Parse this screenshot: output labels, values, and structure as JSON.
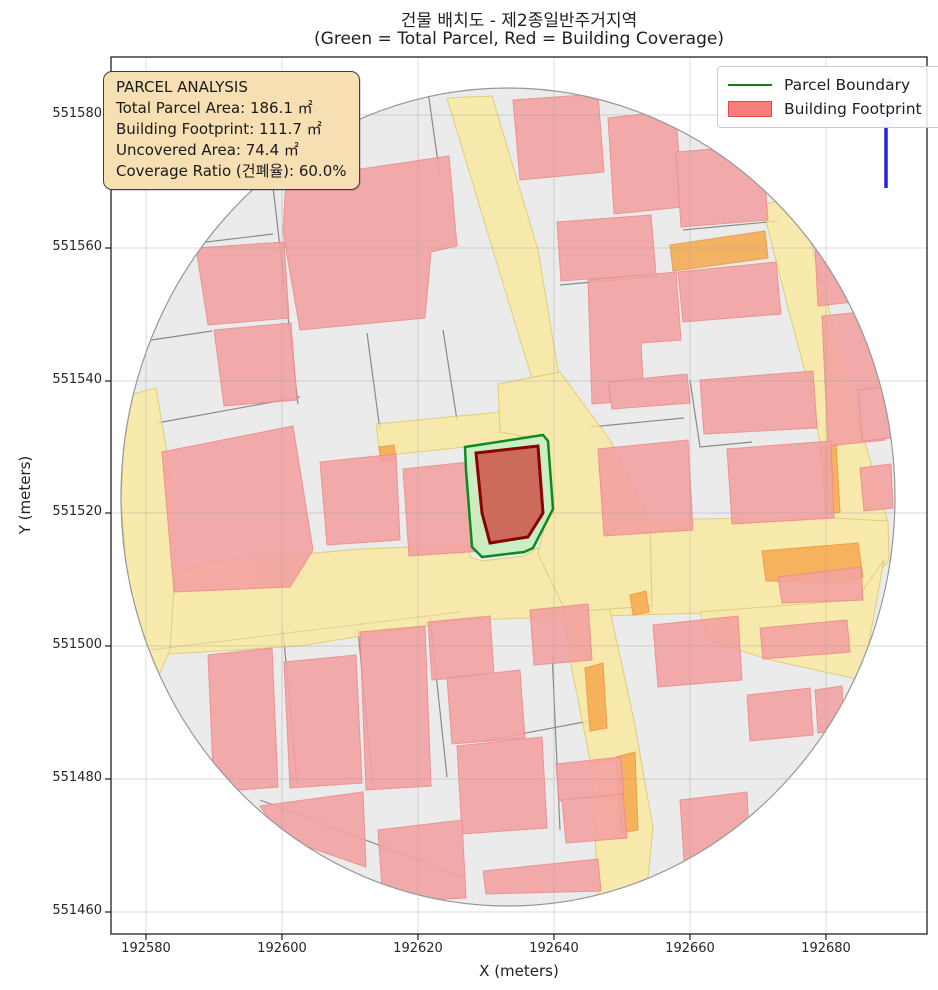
{
  "title": {
    "line1": "건물 배치도 - 제2종일반주거지역",
    "line2": "(Green = Total Parcel, Red = Building Coverage)"
  },
  "axis": {
    "xlabel": "X (meters)",
    "ylabel": "Y (meters)",
    "x_ticks": [
      "192580",
      "192600",
      "192620",
      "192640",
      "192660",
      "192680"
    ],
    "y_ticks": [
      "551580",
      "551560",
      "551540",
      "551520",
      "551500",
      "551480",
      "551460"
    ]
  },
  "info_box": {
    "lines": [
      "PARCEL ANALYSIS",
      "Total Parcel Area: 186.1 ㎡",
      "Building Footprint: 111.7 ㎡",
      "Uncovered Area: 74.4 ㎡",
      "Coverage Ratio (건폐율): 60.0%"
    ]
  },
  "legend": {
    "items": [
      {
        "label": "Parcel Boundary",
        "type": "line",
        "color": "#157F15"
      },
      {
        "label": "Building Footprint",
        "type": "patch",
        "color": "#FA7B7B"
      }
    ]
  },
  "north": {
    "label": "N"
  },
  "analysis": {
    "total_parcel_area_m2": 186.1,
    "building_footprint_m2": 111.7,
    "uncovered_area_m2": 74.4,
    "coverage_ratio_pct": 60.0,
    "zoning": "제2종일반주거지역"
  },
  "colors": {
    "parcel_base": "#EBEBEB",
    "parcel_line": "#8a8a8a",
    "road": "#FAE99A",
    "orange_lot": "#F6A94E",
    "building": "#F3A2A2",
    "subject_parcel_fill": "#C9EFC2",
    "subject_parcel_edge": "#0E8A1E",
    "subject_building_fill": "#CC5B50",
    "subject_building_edge": "#8B0000",
    "north_blue": "#2323DF",
    "info_bg": "#F6DFB2"
  },
  "grid": {
    "x_px": [
      146,
      282,
      418,
      554,
      690,
      826
    ],
    "y_px": [
      115,
      248,
      381,
      513,
      646,
      779,
      912
    ]
  },
  "map": {
    "circle": {
      "cx": 508,
      "cy": 497,
      "rx": 387,
      "ry": 409
    },
    "roads": [
      [
        [
          447,
          98
        ],
        [
          492,
          96
        ],
        [
          538,
          250
        ],
        [
          566,
          418
        ],
        [
          549,
          434
        ],
        [
          508,
          300
        ]
      ],
      [
        [
          376,
          424
        ],
        [
          554,
          407
        ],
        [
          558,
          437
        ],
        [
          380,
          456
        ]
      ],
      [
        [
          762,
          205
        ],
        [
          798,
          196
        ],
        [
          826,
          298
        ],
        [
          852,
          398
        ],
        [
          888,
          522
        ],
        [
          886,
          552
        ],
        [
          838,
          545
        ],
        [
          812,
          398
        ],
        [
          786,
          300
        ]
      ],
      [
        [
          126,
          588
        ],
        [
          210,
          562
        ],
        [
          360,
          549
        ],
        [
          468,
          545
        ],
        [
          470,
          557
        ],
        [
          482,
          561
        ],
        [
          524,
          556
        ],
        [
          536,
          549
        ],
        [
          600,
          522
        ],
        [
          700,
          519
        ],
        [
          812,
          517
        ],
        [
          888,
          521
        ],
        [
          889,
          560
        ],
        [
          855,
          602
        ],
        [
          740,
          612
        ],
        [
          600,
          616
        ],
        [
          460,
          620
        ],
        [
          300,
          646
        ],
        [
          168,
          654
        ],
        [
          128,
          636
        ]
      ],
      [
        [
          563,
          610
        ],
        [
          608,
          602
        ],
        [
          634,
          720
        ],
        [
          653,
          828
        ],
        [
          647,
          886
        ],
        [
          598,
          897
        ],
        [
          592,
          770
        ],
        [
          570,
          660
        ]
      ],
      [
        [
          498,
          384
        ],
        [
          560,
          372
        ],
        [
          610,
          440
        ],
        [
          650,
          520
        ],
        [
          652,
          606
        ],
        [
          566,
          612
        ],
        [
          538,
          554
        ],
        [
          547,
          515
        ],
        [
          544,
          440
        ],
        [
          500,
          432
        ]
      ],
      [
        [
          126,
          396
        ],
        [
          156,
          388
        ],
        [
          170,
          470
        ],
        [
          176,
          556
        ],
        [
          170,
          650
        ],
        [
          148,
          700
        ],
        [
          130,
          618
        ],
        [
          121,
          500
        ]
      ],
      [
        [
          700,
          612
        ],
        [
          856,
          600
        ],
        [
          884,
          560
        ],
        [
          862,
          680
        ],
        [
          770,
          660
        ],
        [
          708,
          640
        ]
      ]
    ],
    "orange_lots": [
      [
        [
          670,
          245
        ],
        [
          765,
          231
        ],
        [
          768,
          258
        ],
        [
          673,
          271
        ]
      ],
      [
        [
          820,
          447
        ],
        [
          836,
          443
        ],
        [
          840,
          512
        ],
        [
          826,
          515
        ]
      ],
      [
        [
          762,
          551
        ],
        [
          858,
          543
        ],
        [
          863,
          577
        ],
        [
          848,
          582
        ],
        [
          766,
          581
        ]
      ],
      [
        [
          585,
          668
        ],
        [
          603,
          663
        ],
        [
          607,
          728
        ],
        [
          590,
          731
        ]
      ],
      [
        [
          616,
          757
        ],
        [
          635,
          752
        ],
        [
          638,
          830
        ],
        [
          621,
          833
        ]
      ],
      [
        [
          379,
          447
        ],
        [
          394,
          445
        ],
        [
          396,
          460
        ],
        [
          381,
          462
        ]
      ],
      [
        [
          630,
          595
        ],
        [
          646,
          591
        ],
        [
          649,
          612
        ],
        [
          633,
          615
        ]
      ]
    ],
    "buildings": [
      [
        [
          286,
          180
        ],
        [
          449,
          156
        ],
        [
          457,
          246
        ],
        [
          431,
          252
        ],
        [
          425,
          318
        ],
        [
          300,
          330
        ],
        [
          283,
          232
        ]
      ],
      [
        [
          196,
          248
        ],
        [
          284,
          242
        ],
        [
          289,
          318
        ],
        [
          208,
          325
        ]
      ],
      [
        [
          214,
          330
        ],
        [
          291,
          323
        ],
        [
          297,
          400
        ],
        [
          224,
          406
        ]
      ],
      [
        [
          162,
          452
        ],
        [
          293,
          426
        ],
        [
          313,
          550
        ],
        [
          290,
          587
        ],
        [
          174,
          592
        ]
      ],
      [
        [
          320,
          462
        ],
        [
          396,
          454
        ],
        [
          400,
          540
        ],
        [
          327,
          545
        ]
      ],
      [
        [
          403,
          469
        ],
        [
          478,
          461
        ],
        [
          483,
          551
        ],
        [
          409,
          556
        ]
      ],
      [
        [
          513,
          100
        ],
        [
          598,
          94
        ],
        [
          604,
          172
        ],
        [
          520,
          180
        ]
      ],
      [
        [
          608,
          118
        ],
        [
          676,
          110
        ],
        [
          682,
          207
        ],
        [
          614,
          214
        ]
      ],
      [
        [
          676,
          152
        ],
        [
          762,
          145
        ],
        [
          768,
          220
        ],
        [
          681,
          227
        ]
      ],
      [
        [
          557,
          222
        ],
        [
          651,
          215
        ],
        [
          656,
          274
        ],
        [
          561,
          281
        ]
      ],
      [
        [
          588,
          280
        ],
        [
          676,
          272
        ],
        [
          681,
          340
        ],
        [
          641,
          343
        ],
        [
          644,
          400
        ],
        [
          592,
          404
        ]
      ],
      [
        [
          678,
          272
        ],
        [
          776,
          262
        ],
        [
          781,
          314
        ],
        [
          683,
          322
        ]
      ],
      [
        [
          815,
          246
        ],
        [
          850,
          240
        ],
        [
          853,
          302
        ],
        [
          818,
          306
        ]
      ],
      [
        [
          822,
          316
        ],
        [
          879,
          310
        ],
        [
          885,
          440
        ],
        [
          828,
          446
        ]
      ],
      [
        [
          598,
          449
        ],
        [
          688,
          440
        ],
        [
          693,
          530
        ],
        [
          604,
          536
        ]
      ],
      [
        [
          727,
          449
        ],
        [
          831,
          441
        ],
        [
          834,
          518
        ],
        [
          732,
          524
        ]
      ],
      [
        [
          858,
          390
        ],
        [
          889,
          386
        ],
        [
          891,
          438
        ],
        [
          862,
          441
        ]
      ],
      [
        [
          860,
          468
        ],
        [
          891,
          464
        ],
        [
          893,
          508
        ],
        [
          864,
          511
        ]
      ],
      [
        [
          608,
          382
        ],
        [
          687,
          374
        ],
        [
          690,
          403
        ],
        [
          612,
          409
        ]
      ],
      [
        [
          700,
          380
        ],
        [
          813,
          371
        ],
        [
          817,
          428
        ],
        [
          704,
          434
        ]
      ],
      [
        [
          208,
          655
        ],
        [
          272,
          648
        ],
        [
          278,
          787
        ],
        [
          214,
          792
        ]
      ],
      [
        [
          284,
          662
        ],
        [
          356,
          655
        ],
        [
          362,
          783
        ],
        [
          290,
          788
        ]
      ],
      [
        [
          360,
          632
        ],
        [
          425,
          626
        ],
        [
          431,
          786
        ],
        [
          366,
          790
        ]
      ],
      [
        [
          428,
          622
        ],
        [
          490,
          616
        ],
        [
          494,
          675
        ],
        [
          432,
          680
        ]
      ],
      [
        [
          447,
          678
        ],
        [
          520,
          670
        ],
        [
          525,
          738
        ],
        [
          452,
          744
        ]
      ],
      [
        [
          457,
          746
        ],
        [
          542,
          737
        ],
        [
          547,
          828
        ],
        [
          462,
          834
        ]
      ],
      [
        [
          483,
          871
        ],
        [
          598,
          859
        ],
        [
          601,
          891
        ],
        [
          486,
          894
        ]
      ],
      [
        [
          260,
          806
        ],
        [
          363,
          792
        ],
        [
          366,
          867
        ],
        [
          282,
          838
        ]
      ],
      [
        [
          378,
          830
        ],
        [
          462,
          820
        ],
        [
          466,
          898
        ],
        [
          383,
          902
        ]
      ],
      [
        [
          556,
          764
        ],
        [
          621,
          757
        ],
        [
          624,
          796
        ],
        [
          559,
          801
        ]
      ],
      [
        [
          562,
          800
        ],
        [
          623,
          794
        ],
        [
          627,
          838
        ],
        [
          566,
          843
        ]
      ],
      [
        [
          530,
          610
        ],
        [
          588,
          604
        ],
        [
          592,
          660
        ],
        [
          534,
          665
        ]
      ],
      [
        [
          653,
          625
        ],
        [
          738,
          616
        ],
        [
          742,
          680
        ],
        [
          658,
          687
        ]
      ],
      [
        [
          747,
          695
        ],
        [
          810,
          688
        ],
        [
          813,
          735
        ],
        [
          750,
          741
        ]
      ],
      [
        [
          760,
          628
        ],
        [
          847,
          620
        ],
        [
          850,
          652
        ],
        [
          763,
          659
        ]
      ],
      [
        [
          680,
          800
        ],
        [
          747,
          792
        ],
        [
          750,
          855
        ],
        [
          684,
          860
        ]
      ],
      [
        [
          778,
          577
        ],
        [
          861,
          567
        ],
        [
          863,
          600
        ],
        [
          782,
          603
        ]
      ],
      [
        [
          815,
          690
        ],
        [
          842,
          686
        ],
        [
          844,
          730
        ],
        [
          818,
          733
        ]
      ]
    ],
    "parcel_lines": [
      [
        [
          272,
          178
        ],
        [
          298,
          404
        ]
      ],
      [
        [
          190,
          244
        ],
        [
          273,
          234
        ]
      ],
      [
        [
          118,
          345
        ],
        [
          212,
          331
        ]
      ],
      [
        [
          157,
          423
        ],
        [
          300,
          397
        ]
      ],
      [
        [
          367,
          333
        ],
        [
          380,
          430
        ]
      ],
      [
        [
          443,
          330
        ],
        [
          457,
          420
        ]
      ],
      [
        [
          270,
          124
        ],
        [
          283,
          177
        ]
      ],
      [
        [
          427,
          84
        ],
        [
          440,
          177
        ]
      ],
      [
        [
          590,
          427
        ],
        [
          684,
          418
        ]
      ],
      [
        [
          690,
          380
        ],
        [
          700,
          447
        ],
        [
          752,
          442
        ]
      ],
      [
        [
          552,
          653
        ],
        [
          560,
          830
        ]
      ],
      [
        [
          483,
          741
        ],
        [
          600,
          719
        ]
      ],
      [
        [
          283,
          630
        ],
        [
          297,
          783
        ]
      ],
      [
        [
          358,
          630
        ],
        [
          373,
          787
        ]
      ],
      [
        [
          430,
          617
        ],
        [
          447,
          777
        ]
      ],
      [
        [
          260,
          800
        ],
        [
          463,
          877
        ]
      ],
      [
        [
          150,
          650
        ],
        [
          460,
          612
        ]
      ],
      [
        [
          683,
          230
        ],
        [
          778,
          221
        ]
      ],
      [
        [
          560,
          285
        ],
        [
          658,
          276
        ]
      ]
    ],
    "subject_parcel": [
      [
        465,
        447
      ],
      [
        543,
        435
      ],
      [
        548,
        441
      ],
      [
        553,
        509
      ],
      [
        533,
        548
      ],
      [
        524,
        552
      ],
      [
        482,
        557
      ],
      [
        472,
        547
      ],
      [
        466,
        470
      ]
    ],
    "subject_building": [
      [
        476,
        453
      ],
      [
        538,
        446
      ],
      [
        543,
        513
      ],
      [
        528,
        537
      ],
      [
        490,
        543
      ],
      [
        482,
        513
      ]
    ],
    "north_arrow": {
      "x": 886,
      "line_y1": 188,
      "line_y2": 121,
      "head": [
        [
          886,
          97
        ],
        [
          878,
          127
        ],
        [
          894,
          127
        ]
      ],
      "label_y": 88
    }
  }
}
